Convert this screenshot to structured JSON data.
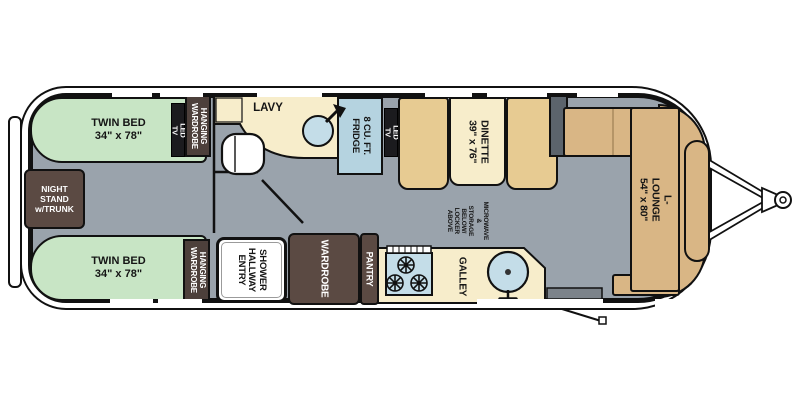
{
  "title": "Travel trailer floor plan - twin bed layout",
  "labels": {
    "twin_bed": "TWIN BED\n34\" x 78\"",
    "night_stand": "NIGHT\nSTAND\nw/TRUNK",
    "hanging_wardrobe": "HANGING\nWARDROBE",
    "led_tv": "LED TV",
    "lavy": "LAVY",
    "fridge": "8 CU. FT.\nFRIDGE",
    "dinette": "DINETTE\n39\" x 76\"",
    "microwave_note": "MICROWAVE &\nSTORAGE BELOW/\nLOCKER ABOVE",
    "l_lounge": "L-LOUNGE\n54\" x 80\"",
    "galley": "GALLEY",
    "pantry": "PANTRY",
    "wardrobe": "WARDROBE",
    "shower": "SHOWER\nHALLWAY\nENTRY"
  },
  "colors": {
    "floor_gray": "#9aa3ac",
    "bed_green": "#c8e5c5",
    "wood_brown": "#5b4a43",
    "counter_cream": "#f7edcb",
    "bench_tan": "#e7cb92",
    "lounge_tan": "#d9b685",
    "appliance_blue": "#b5d3e0",
    "tv_black": "#1b1b1e",
    "wall_black": "#111111",
    "cabinet_gray": "#5c646c"
  }
}
